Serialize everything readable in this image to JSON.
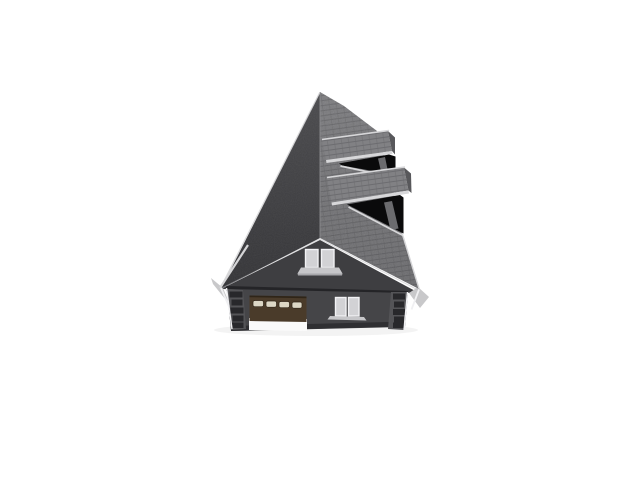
{
  "window": {
    "width": 640,
    "height": 480
  },
  "scene": {
    "subject": "3D computer rendering of a two-story gabled house with attached garage, seen from above the front facade, centered on a plain white background",
    "view": "aerial front elevation, slight perspective",
    "roof": {
      "type": "gable",
      "left_plane": "dark charcoal asphalt shingle plane",
      "right_plane": "medium gray asphalt shingle plane with visible shingle rows",
      "skylight_count": 2,
      "skylight_description": "two raised shingled panels each above a dark triangular roof opening on the right plane"
    },
    "facade": {
      "gable_window_panes": 2,
      "first_floor_window_panes": 2,
      "garage_door_windows": 4,
      "corner_quoins": true
    },
    "colors": {
      "background": "#ffffff",
      "roof_left_top": "#4a4a4d",
      "roof_left_bottom": "#333336",
      "roof_right_top": "#7c7c7f",
      "roof_right_bottom": "#6a6a6d",
      "roof_row_line": "rgba(25,25,30,0.20)",
      "roof_row_line_soft": "rgba(25,25,30,0.10)",
      "ridge_line": "#8b8b8e",
      "rake_highlight": "#b9b9bd",
      "fascia": "#d5d5d7",
      "soffit": "#c8c8ca",
      "gable_wall": "#3e3e41",
      "eave_shadow": "#242427",
      "first_floor_wall": "#454548",
      "wall_base": "#2c2c2f",
      "quoin_strip": "#545457",
      "quoin_block": "#28282b",
      "corner_trim": "#f0f0f2",
      "window_frame": "#f2f2f4",
      "window_pane": "#d2d2d5",
      "sill": "#c6c6c9",
      "sill_edge": "#a7a7aa",
      "garage_door": "#4a3b2a",
      "garage_door_edge": "#2f2518",
      "garage_window": "#dcd7c6",
      "garage_apron": "#fafafa",
      "panel_top": "#818184",
      "panel_side": "#58585b",
      "panel_trim": "#d7d7d9",
      "opening": "#0a0a0b",
      "opening_inner": "#6b6b6e",
      "ground_shadow": "#1a1a1c"
    }
  }
}
